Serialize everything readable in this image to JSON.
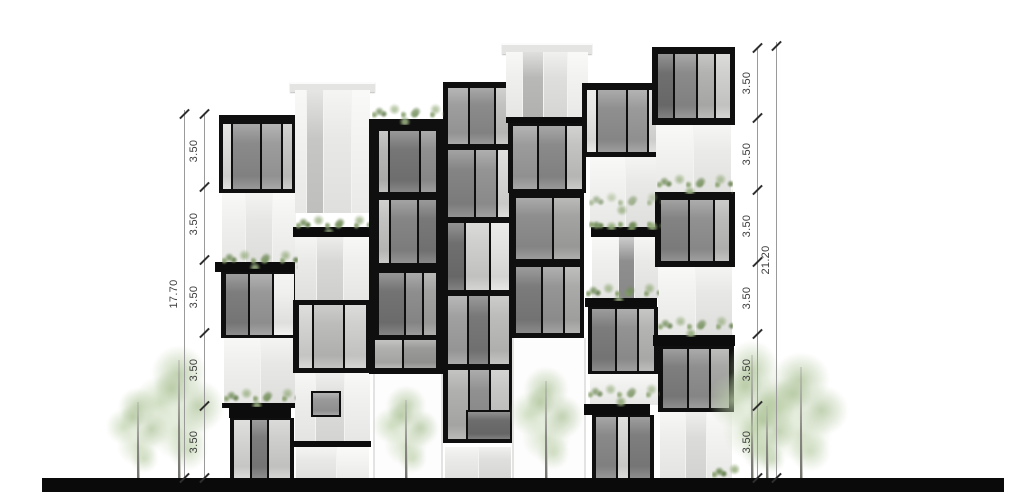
{
  "title": "building-elevation-drawing",
  "canvas": {
    "w": 1024,
    "h": 493,
    "bg": "#ffffff"
  },
  "palette": {
    "frame": "#0f0f0f",
    "slab": "#0c0c0c",
    "ground": "#0a0a0a",
    "white_module": "#f3f3f1",
    "cap": "#e4e4e2",
    "opening": "#fdfdfd",
    "dim_line": "#9a9a9a",
    "dim_tick": "#2e2e2e",
    "dim_text": "#3d3d3d"
  },
  "ground": {
    "x": 42,
    "y": 478,
    "w": 962,
    "h": 14
  },
  "dimensions": {
    "left": {
      "line_x": 204,
      "total_line_x": 184,
      "label_dx": -10,
      "floor_ys": [
        114,
        187,
        260,
        333,
        406,
        478
      ],
      "segment_labels": [
        "3.50",
        "3.50",
        "3.50",
        "3.50",
        "3.50"
      ],
      "total_label": "17.70",
      "total_top_y": 110
    },
    "right": {
      "line_x": 757,
      "total_line_x": 776,
      "label_dx": -10,
      "floor_ys": [
        48,
        118,
        190,
        262,
        334,
        406,
        478
      ],
      "segment_labels": [
        "3.50",
        "3.50",
        "3.50",
        "3.50",
        "3.50",
        "3.50"
      ],
      "total_label": "21.20",
      "total_top_y": 42
    }
  },
  "building": {
    "modules": [
      {
        "t": "g",
        "x": 219,
        "y": 115,
        "w": 80,
        "h": 78,
        "f": [
          9,
          7,
          4,
          4
        ],
        "p": [
          [
            "#dededc",
            0.5
          ],
          [
            "#8a8a8a",
            1.7
          ],
          [
            "#9c9c9c",
            1.2
          ],
          [
            "#c6c6c4",
            0.6
          ]
        ]
      },
      {
        "t": "w",
        "x": 222,
        "y": 193,
        "w": 74,
        "h": 70,
        "p": [
          [
            "#f0f0ee",
            1
          ],
          [
            "#e6e6e4",
            1.1
          ],
          [
            "#f2f2f0",
            1
          ]
        ]
      },
      {
        "t": "s",
        "x": 215,
        "y": 262,
        "w": 86,
        "h": 10
      },
      {
        "t": "g",
        "x": 221,
        "y": 272,
        "w": 77,
        "h": 66,
        "f": [
          2,
          4,
          3,
          5
        ],
        "p": [
          [
            "#7d7d7d",
            1.1
          ],
          [
            "#989898",
            1.1
          ],
          [
            "#f0f0ee",
            1
          ]
        ]
      },
      {
        "t": "w",
        "x": 224,
        "y": 338,
        "w": 72,
        "h": 66,
        "p": [
          [
            "#efefed",
            1
          ],
          [
            "#e7e7e5",
            1
          ]
        ]
      },
      {
        "t": "s",
        "x": 222,
        "y": 403,
        "w": 76,
        "h": 5
      },
      {
        "t": "s",
        "x": 229,
        "y": 408,
        "w": 62,
        "h": 10
      },
      {
        "t": "g",
        "x": 230,
        "y": 418,
        "w": 64,
        "h": 60,
        "f": [
          2,
          4,
          0,
          4
        ],
        "p": [
          [
            "#d5d5d3",
            0.9
          ],
          [
            "#7d7d7d",
            0.9
          ],
          [
            "#cfcfcd",
            1.2
          ]
        ]
      },
      {
        "t": "c",
        "x": 290,
        "y": 82,
        "w": 85,
        "h": 8
      },
      {
        "t": "w",
        "x": 295,
        "y": 90,
        "w": 75,
        "h": 123,
        "p": [
          [
            "#f1f1ef",
            0.55
          ],
          [
            "#c6c6c4",
            0.8
          ],
          [
            "#e8e8e6",
            1.3
          ],
          [
            "#f3f3f1",
            0.9
          ]
        ]
      },
      {
        "t": "s",
        "x": 293,
        "y": 227,
        "w": 78,
        "h": 10
      },
      {
        "t": "w",
        "x": 295,
        "y": 237,
        "w": 75,
        "h": 63,
        "p": [
          [
            "#e9e9e7",
            0.8
          ],
          [
            "#d7d7d5",
            1
          ],
          [
            "#efefed",
            1
          ]
        ]
      },
      {
        "t": "g",
        "x": 293,
        "y": 300,
        "w": 78,
        "h": 73,
        "f": [
          5,
          5,
          5,
          6
        ],
        "p": [
          [
            "#d3d3d1",
            0.6
          ],
          [
            "#bcbcba",
            1.4
          ],
          [
            "#d0d0ce",
            1
          ]
        ]
      },
      {
        "t": "w",
        "x": 295,
        "y": 373,
        "w": 75,
        "h": 68,
        "p": [
          [
            "#ededeb",
            0.8
          ],
          [
            "#dcdcda",
            1.1
          ],
          [
            "#f0f0ee",
            1
          ]
        ]
      },
      {
        "t": "g",
        "x": 311,
        "y": 391,
        "w": 30,
        "h": 26,
        "f": [
          2,
          2,
          2,
          2
        ],
        "p": [
          [
            "#9a9a9a",
            1
          ]
        ]
      },
      {
        "t": "s",
        "x": 294,
        "y": 441,
        "w": 77,
        "h": 6
      },
      {
        "t": "w",
        "x": 296,
        "y": 447,
        "w": 73,
        "h": 31,
        "p": [
          [
            "#e9e9e7",
            1
          ],
          [
            "#f4f4f2",
            0.8
          ]
        ]
      },
      {
        "t": "g",
        "x": 369,
        "y": 119,
        "w": 76,
        "h": 78,
        "f": [
          12,
          9,
          5,
          10
        ],
        "p": [
          [
            "#b7b7b5",
            0.5
          ],
          [
            "#767676",
            1.7
          ],
          [
            "#909090",
            0.9
          ]
        ]
      },
      {
        "t": "g",
        "x": 369,
        "y": 197,
        "w": 76,
        "h": 70,
        "f": [
          3,
          9,
          4,
          10
        ],
        "p": [
          [
            "#c2c2c0",
            0.6
          ],
          [
            "#858585",
            1.5
          ],
          [
            "#787878",
            1
          ]
        ]
      },
      {
        "t": "g",
        "x": 369,
        "y": 267,
        "w": 76,
        "h": 73,
        "f": [
          6,
          9,
          5,
          10
        ],
        "p": [
          [
            "#737373",
            1.5
          ],
          [
            "#8e8e8e",
            1
          ],
          [
            "#a2a2a0",
            0.7
          ]
        ]
      },
      {
        "t": "g",
        "x": 369,
        "y": 340,
        "w": 76,
        "h": 34,
        "f": [
          0,
          9,
          6,
          6
        ],
        "p": [
          [
            "#b0b0ae",
            1
          ],
          [
            "#9a9a98",
            1.2
          ]
        ]
      },
      {
        "t": "o",
        "x": 373,
        "y": 374,
        "w": 66,
        "h": 104
      },
      {
        "t": "g",
        "x": 443,
        "y": 82,
        "w": 70,
        "h": 65,
        "f": [
          6,
          4,
          3,
          5
        ],
        "p": [
          [
            "#9e9e9e",
            1.1
          ],
          [
            "#8b8b8b",
            1.3
          ],
          [
            "#c2c2c0",
            0.7
          ]
        ]
      },
      {
        "t": "g",
        "x": 443,
        "y": 147,
        "w": 70,
        "h": 73,
        "f": [
          3,
          4,
          3,
          5
        ],
        "p": [
          [
            "#848484",
            1.4
          ],
          [
            "#949494",
            1.1
          ],
          [
            "#d8d8d6",
            0.6
          ]
        ]
      },
      {
        "t": "g",
        "x": 443,
        "y": 220,
        "w": 70,
        "h": 73,
        "f": [
          3,
          4,
          3,
          5
        ],
        "p": [
          [
            "#6f6f6f",
            0.8
          ],
          [
            "#cfcfcd",
            1.2
          ],
          [
            "#e4e4e2",
            0.9
          ]
        ]
      },
      {
        "t": "g",
        "x": 443,
        "y": 293,
        "w": 70,
        "h": 74,
        "f": [
          3,
          4,
          3,
          5
        ],
        "p": [
          [
            "#a0a0a0",
            1
          ],
          [
            "#787878",
            1
          ],
          [
            "#bcbcba",
            1
          ]
        ]
      },
      {
        "t": "g",
        "x": 443,
        "y": 367,
        "w": 70,
        "h": 76,
        "f": [
          3,
          4,
          4,
          5
        ],
        "p": [
          [
            "#b0b0ae",
            1
          ],
          [
            "#909090",
            1
          ],
          [
            "#c6c6c4",
            0.9
          ]
        ]
      },
      {
        "t": "g",
        "x": 466,
        "y": 410,
        "w": 46,
        "h": 31,
        "f": [
          2,
          2,
          2,
          2
        ],
        "p": [
          [
            "#6d6d6d",
            1
          ]
        ]
      },
      {
        "t": "w",
        "x": 445,
        "y": 447,
        "w": 66,
        "h": 31,
        "p": [
          [
            "#eaeae8",
            1
          ],
          [
            "#dfdfdd",
            1
          ]
        ]
      },
      {
        "t": "c",
        "x": 502,
        "y": 43,
        "w": 90,
        "h": 9
      },
      {
        "t": "w",
        "x": 506,
        "y": 52,
        "w": 82,
        "h": 65,
        "p": [
          [
            "#efefed",
            0.7
          ],
          [
            "#b8b8b6",
            0.9
          ],
          [
            "#dededc",
            1
          ],
          [
            "#f2f2f0",
            0.9
          ]
        ]
      },
      {
        "t": "s",
        "x": 506,
        "y": 117,
        "w": 82,
        "h": 6
      },
      {
        "t": "g",
        "x": 508,
        "y": 123,
        "w": 78,
        "h": 70,
        "f": [
          3,
          4,
          4,
          5
        ],
        "p": [
          [
            "#9b9b9b",
            1.1
          ],
          [
            "#8a8a8a",
            1.2
          ],
          [
            "#c3c3c1",
            0.7
          ]
        ]
      },
      {
        "t": "g",
        "x": 510,
        "y": 193,
        "w": 74,
        "h": 70,
        "f": [
          5,
          4,
          4,
          6
        ],
        "p": [
          [
            "#8e8e8e",
            1.4
          ],
          [
            "#a3a3a1",
            1
          ]
        ]
      },
      {
        "t": "g",
        "x": 510,
        "y": 263,
        "w": 74,
        "h": 75,
        "f": [
          4,
          4,
          5,
          6
        ],
        "p": [
          [
            "#7b7b7b",
            1.3
          ],
          [
            "#959595",
            1
          ],
          [
            "#aaaaa8",
            0.8
          ]
        ]
      },
      {
        "t": "o",
        "x": 512,
        "y": 338,
        "w": 70,
        "h": 140
      },
      {
        "t": "g",
        "x": 582,
        "y": 83,
        "w": 80,
        "h": 74,
        "f": [
          7,
          4,
          5,
          5
        ],
        "p": [
          [
            "#e6e6e4",
            0.5
          ],
          [
            "#8f8f8f",
            1.5
          ],
          [
            "#9a9a9a",
            1
          ],
          [
            "#dcdcda",
            0.5
          ]
        ]
      },
      {
        "t": "w",
        "x": 590,
        "y": 157,
        "w": 70,
        "h": 70,
        "p": [
          [
            "#f1f1ef",
            1
          ],
          [
            "#e8e8e6",
            1
          ]
        ]
      },
      {
        "t": "s",
        "x": 591,
        "y": 227,
        "w": 71,
        "h": 10
      },
      {
        "t": "w",
        "x": 592,
        "y": 237,
        "w": 69,
        "h": 61,
        "p": [
          [
            "#efefed",
            1
          ],
          [
            "#8e8e8e",
            0.55
          ],
          [
            "#e9e9e7",
            1
          ]
        ]
      },
      {
        "t": "s",
        "x": 585,
        "y": 298,
        "w": 72,
        "h": 9
      },
      {
        "t": "g",
        "x": 588,
        "y": 307,
        "w": 70,
        "h": 67,
        "f": [
          2,
          4,
          3,
          4
        ],
        "p": [
          [
            "#7c7c7c",
            1.2
          ],
          [
            "#939393",
            1
          ],
          [
            "#b4b4b2",
            0.8
          ]
        ]
      },
      {
        "t": "w",
        "x": 590,
        "y": 374,
        "w": 70,
        "h": 31,
        "p": [
          [
            "#f0f0ee",
            1
          ]
        ]
      },
      {
        "t": "s",
        "x": 584,
        "y": 404,
        "w": 66,
        "h": 11
      },
      {
        "t": "g",
        "x": 592,
        "y": 415,
        "w": 62,
        "h": 63,
        "f": [
          2,
          4,
          0,
          4
        ],
        "p": [
          [
            "#898989",
            1.2
          ],
          [
            "#d6d6d4",
            0.6
          ],
          [
            "#7e7e7e",
            1.2
          ]
        ]
      },
      {
        "t": "g",
        "x": 652,
        "y": 47,
        "w": 83,
        "h": 78,
        "f": [
          7,
          5,
          7,
          6
        ],
        "p": [
          [
            "#6f6f6f",
            0.9
          ],
          [
            "#8a8a8a",
            1.2
          ],
          [
            "#b2b2b0",
            1
          ],
          [
            "#d0d0ce",
            0.8
          ]
        ]
      },
      {
        "t": "w",
        "x": 656,
        "y": 125,
        "w": 75,
        "h": 67,
        "p": [
          [
            "#f2f2f0",
            1
          ],
          [
            "#eaeae8",
            1
          ]
        ]
      },
      {
        "t": "g",
        "x": 655,
        "y": 192,
        "w": 80,
        "h": 75,
        "f": [
          8,
          6,
          6,
          6
        ],
        "p": [
          [
            "#838383",
            1.3
          ],
          [
            "#919191",
            1.1
          ],
          [
            "#bbbbb9",
            0.7
          ]
        ]
      },
      {
        "t": "w",
        "x": 658,
        "y": 267,
        "w": 74,
        "h": 68,
        "p": [
          [
            "#f1f1ef",
            1
          ],
          [
            "#e7e7e5",
            1
          ]
        ]
      },
      {
        "t": "s",
        "x": 653,
        "y": 335,
        "w": 82,
        "h": 11
      },
      {
        "t": "g",
        "x": 658,
        "y": 346,
        "w": 76,
        "h": 66,
        "f": [
          3,
          5,
          4,
          5
        ],
        "p": [
          [
            "#7e7e7e",
            1.2
          ],
          [
            "#8f8f8f",
            1
          ],
          [
            "#a8a8a6",
            0.9
          ]
        ]
      },
      {
        "t": "w",
        "x": 660,
        "y": 412,
        "w": 72,
        "h": 66,
        "p": [
          [
            "#ededeb",
            1
          ],
          [
            "#dbdbd9",
            0.8
          ],
          [
            "#f2f2f0",
            1
          ]
        ]
      }
    ]
  },
  "plants": [
    {
      "x": 222,
      "y": 243,
      "w": 76,
      "h": 26
    },
    {
      "x": 224,
      "y": 381,
      "w": 72,
      "h": 26
    },
    {
      "x": 296,
      "y": 208,
      "w": 73,
      "h": 24
    },
    {
      "x": 372,
      "y": 97,
      "w": 72,
      "h": 28
    },
    {
      "x": 589,
      "y": 185,
      "w": 72,
      "h": 45
    },
    {
      "x": 586,
      "y": 276,
      "w": 73,
      "h": 25
    },
    {
      "x": 588,
      "y": 377,
      "w": 72,
      "h": 30
    },
    {
      "x": 657,
      "y": 167,
      "w": 76,
      "h": 27
    },
    {
      "x": 658,
      "y": 309,
      "w": 75,
      "h": 28
    },
    {
      "x": 712,
      "y": 457,
      "w": 28,
      "h": 21
    }
  ],
  "trees": [
    {
      "trunk_x": 138,
      "top": 388,
      "cw": 62,
      "ch": 86
    },
    {
      "trunk_x": 179,
      "top": 346,
      "cw": 88,
      "ch": 126
    },
    {
      "trunk_x": 406,
      "top": 386,
      "cw": 64,
      "ch": 88
    },
    {
      "trunk_x": 546,
      "top": 367,
      "cw": 72,
      "ch": 104
    },
    {
      "trunk_x": 752,
      "top": 341,
      "cw": 86,
      "ch": 132
    },
    {
      "trunk_x": 767,
      "top": 392,
      "cw": 56,
      "ch": 82
    },
    {
      "trunk_x": 801,
      "top": 353,
      "cw": 92,
      "ch": 120
    }
  ]
}
